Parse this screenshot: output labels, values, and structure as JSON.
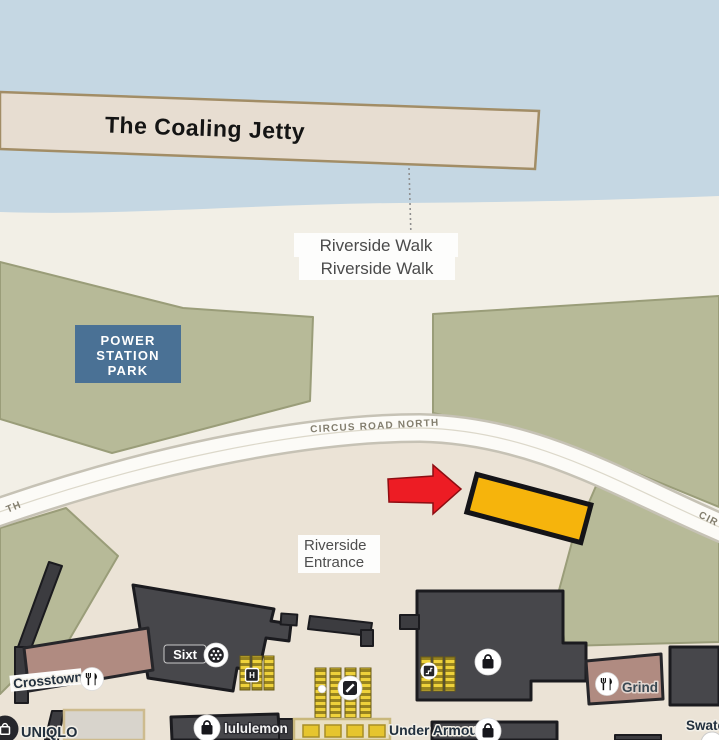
{
  "colors": {
    "water": "#c5d7e3",
    "land": "#f2efe6",
    "plaza": "#ebe3d6",
    "park_green": "#b7ba98",
    "park_sign_blue": "#4a7195",
    "building_dark": "#47474b",
    "building_mauve": "#b08b81",
    "jetty_fill": "#e7ddd1",
    "road_white": "#fcfbf7",
    "stairs_yellow": "#e8c62f",
    "highlight_yellow": "#f6b40c",
    "arrow_red": "#ed1c24"
  },
  "areas": {
    "jetty_label": "The Coaling Jetty",
    "riverside_walk_label_1": "Riverside Walk",
    "riverside_walk_label_2": "Riverside Walk",
    "park_sign": {
      "line1": "POWER",
      "line2": "STATION",
      "line3": "PARK"
    },
    "entrance_label": {
      "line1": "Riverside",
      "line2": "Entrance"
    }
  },
  "roads": {
    "circus_road_north": "CIRCUS ROAD NORTH",
    "left_edge_fragment": "TH",
    "right_edge_fragment": "CIR"
  },
  "shops": {
    "crosstown": "Crosstown",
    "sixt": "Sixt",
    "uniqlo": "UNIQLO",
    "lululemon": "lululemon",
    "under_armour": "Under Armour",
    "grind": "Grind",
    "swatch_partial": "Swatc"
  },
  "icons": {
    "lift_glyph": "H",
    "restaurant_icon": "fork-knife-icon",
    "shop_icon": "shopping-bag-icon",
    "car_rental_icon": "wheel-icon",
    "escalator_icon": "escalator-icon"
  }
}
